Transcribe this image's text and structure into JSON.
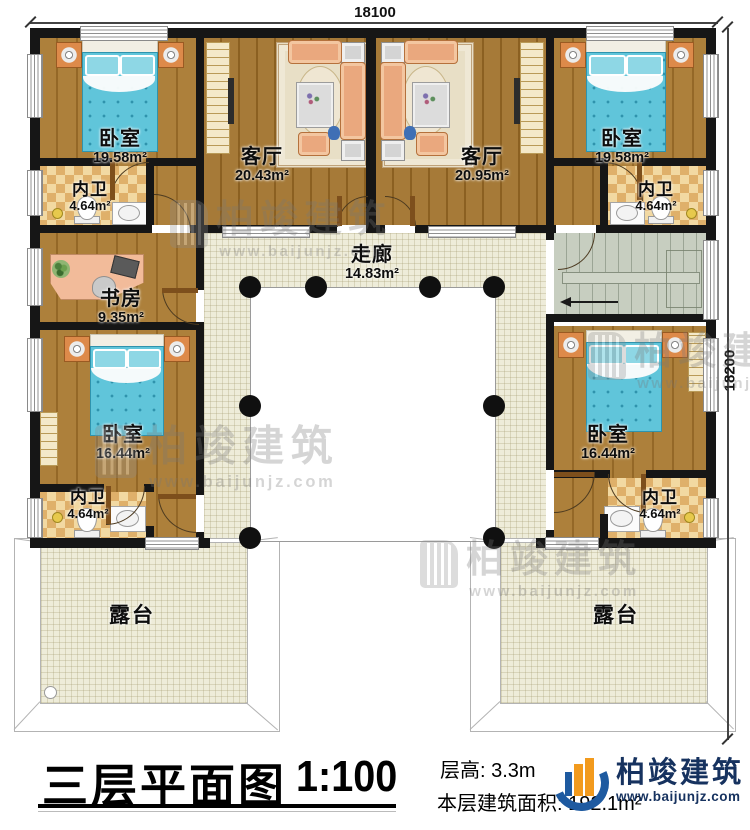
{
  "dimensions": {
    "width_label": "18100",
    "height_label": "18200"
  },
  "rooms": {
    "bedroom_tl": {
      "name": "卧室",
      "area": "19.58m²"
    },
    "bath_tl": {
      "name": "内卫",
      "area": "4.64m²"
    },
    "living_left": {
      "name": "客厅",
      "area": "20.43m²"
    },
    "living_right": {
      "name": "客厅",
      "area": "20.95m²"
    },
    "bedroom_tr": {
      "name": "卧室",
      "area": "19.58m²"
    },
    "bath_tr": {
      "name": "内卫",
      "area": "4.64m²"
    },
    "study": {
      "name": "书房",
      "area": "9.35m²"
    },
    "corridor": {
      "name": "走廊",
      "area": "14.83m²"
    },
    "bedroom_bl": {
      "name": "卧室",
      "area": "16.44m²"
    },
    "bath_bl": {
      "name": "内卫",
      "area": "4.64m²"
    },
    "bedroom_br": {
      "name": "卧室",
      "area": "16.44m²"
    },
    "bath_br": {
      "name": "内卫",
      "area": "4.64m²"
    },
    "terrace_left": {
      "name": "露台"
    },
    "terrace_right": {
      "name": "露台"
    }
  },
  "watermark": {
    "brand": "柏竣建筑",
    "url": "www.baijunjz.com"
  },
  "titleblock": {
    "title": "三层平面图",
    "scale": "1:100",
    "floor_height_label": "层高:",
    "floor_height_value": "3.3m",
    "floor_area_label": "本层建筑面积:",
    "floor_area_value": "192.1m²"
  },
  "logo": {
    "brand": "柏竣建筑",
    "url": "www.baijunjz.com"
  }
}
